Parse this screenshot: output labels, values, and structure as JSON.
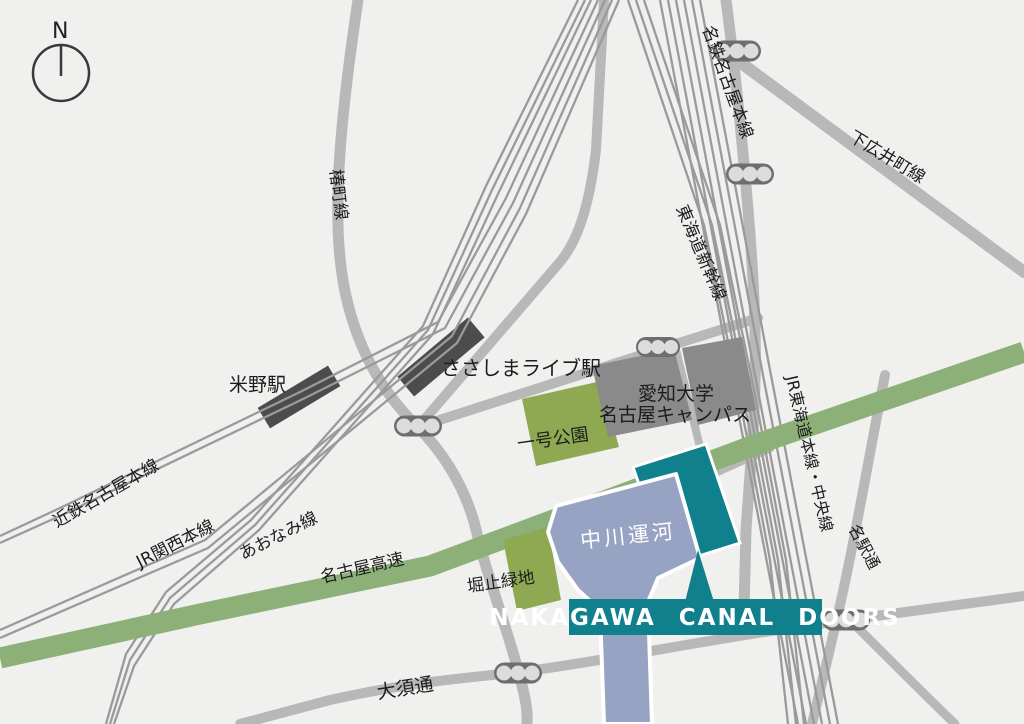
{
  "compass": {
    "north_label": "N"
  },
  "labels": {
    "tsubaki_line": "椿町線",
    "meitetsu_nagoya_main_line": "名鉄名古屋本線",
    "shimohiroicho_line": "下広井町線",
    "tokaido_shinkansen": "東海道新幹線",
    "komeno_station": "米野駅",
    "sasashima_live_station": "ささしまライブ駅",
    "aichi_univ_line1": "愛知大学",
    "aichi_univ_line2": "名古屋キャンパス",
    "ichigo_park": "一号公園",
    "jr_tokaido_chuo_line": "JR東海道本線・中央線",
    "kintetsu_nagoya_main_line": "近鉄名古屋本線",
    "jr_kansai_main_line": "JR関西本線",
    "aonami_line": "あおなみ線",
    "nagoya_expressway": "名古屋高速",
    "horidome_ryokuchi": "堀止緑地",
    "nakagawa_canal": "中川運河",
    "meieki_dori": "名駅通",
    "osu_dori": "大須通",
    "site_banner": "NAKAGAWA CANAL DOORS"
  },
  "colors": {
    "map_background": "#f0f0ee",
    "road_gray": "#b8b8b8",
    "rail_gray": "#9a9a9a",
    "expressway_green": "#8cb078",
    "park_green": "#8fa952",
    "campus_gray": "#8a8a8a",
    "canal_blue": "#97a3c2",
    "brand_teal": "#0f808c",
    "station_dark": "#4c4c4c"
  }
}
